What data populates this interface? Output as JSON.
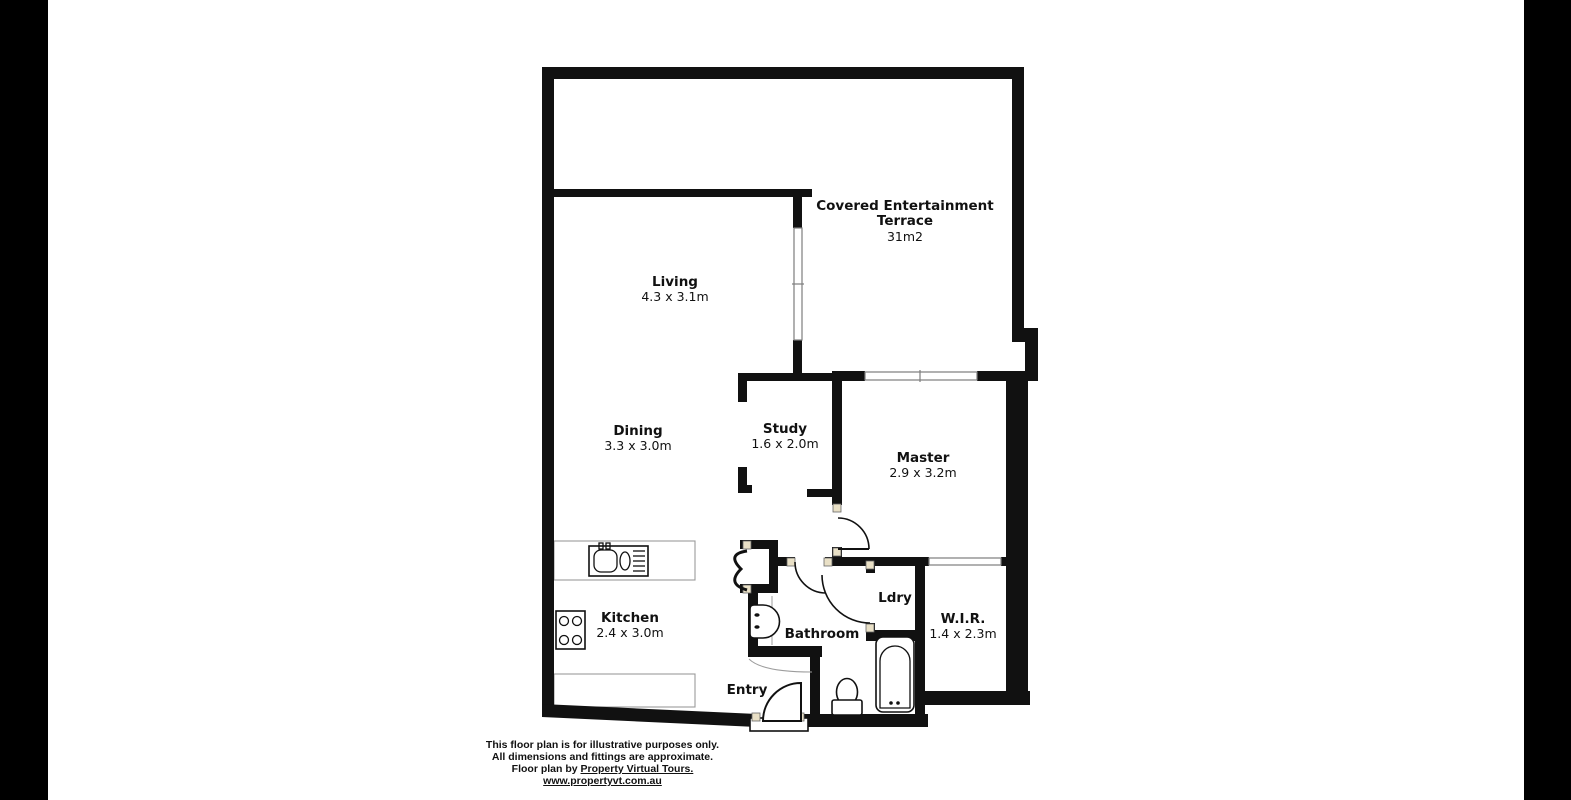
{
  "colors": {
    "wall": "#111111",
    "bg": "#ffffff",
    "letterbox": "#000000",
    "window-line": "#7d7d7d",
    "jamb": "#e9e0c6",
    "counter-line": "#9a9a9a",
    "ink": "#111111"
  },
  "rooms": {
    "terrace": {
      "line1": "Covered Entertainment",
      "line2": "Terrace",
      "area": "31m2"
    },
    "living": {
      "name": "Living",
      "dims": "4.3 x 3.1m"
    },
    "dining": {
      "name": "Dining",
      "dims": "3.3 x 3.0m"
    },
    "study": {
      "name": "Study",
      "dims": "1.6 x 2.0m"
    },
    "master": {
      "name": "Master",
      "dims": "2.9 x 3.2m"
    },
    "kitchen": {
      "name": "Kitchen",
      "dims": "2.4 x 3.0m"
    },
    "bathroom": {
      "name": "Bathroom"
    },
    "laundry": {
      "name": "Ldry"
    },
    "wir": {
      "name": "W.I.R.",
      "dims": "1.4 x 2.3m"
    },
    "entry": {
      "name": "Entry"
    }
  },
  "icons": {
    "sink": "double-sink-icon",
    "stove": "cooktop-icon",
    "toilet_bathroom": "toilet-icon",
    "toilet_entry": "toilet-icon",
    "bathtub": "bathtub-icon",
    "closet_doors": "bifold-door-icon",
    "doors": "door-swing-icon"
  },
  "footer": {
    "line1": "This floor plan is for illustrative purposes only.",
    "line2": "All dimensions and fittings are approximate.",
    "line3_prefix": "Floor plan by ",
    "line3_link": "Property Virtual Tours.",
    "line4": "www.propertyvt.com.au"
  }
}
